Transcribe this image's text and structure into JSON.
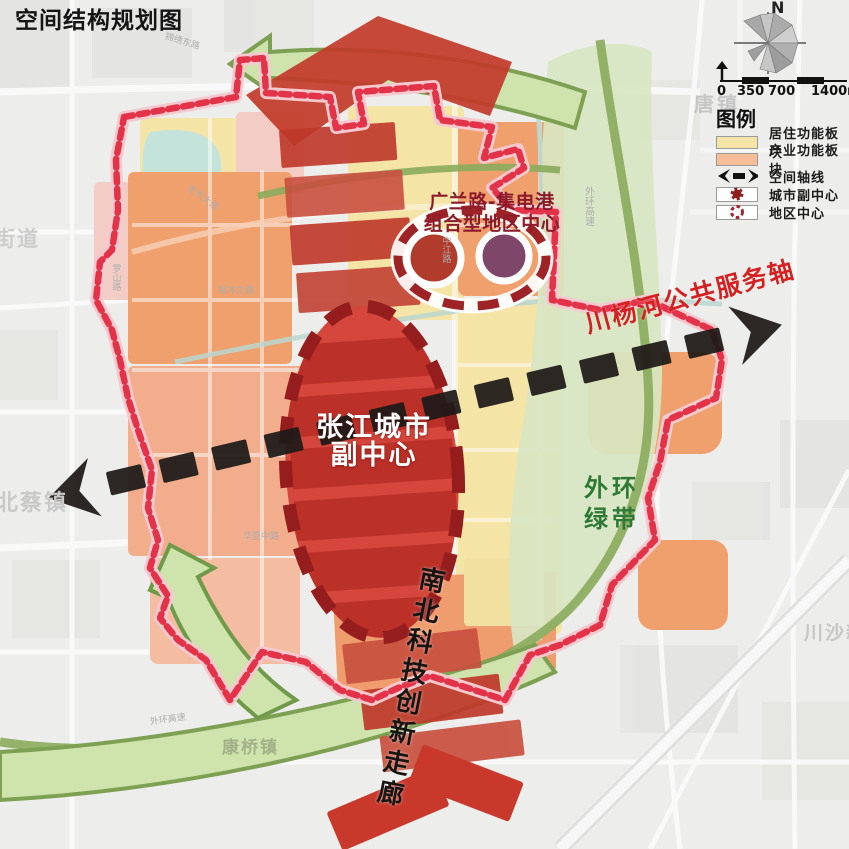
{
  "title": "空间结构规划图",
  "compass": {
    "north": "N"
  },
  "scale_bar": {
    "labels": [
      "0",
      "350",
      "700",
      "1400m"
    ]
  },
  "legend": {
    "title": "图例",
    "items": [
      {
        "label": "居住功能板块"
      },
      {
        "label": "产业功能板块"
      },
      {
        "label": "空间轴线"
      },
      {
        "label": "城市副中心"
      },
      {
        "label": "地区中心"
      }
    ]
  },
  "map": {
    "city_subcenter_line1": "张江城市",
    "city_subcenter_line2": "副中心",
    "district_center_line1": "广兰路-集电港",
    "district_center_line2": "组合型地区中心",
    "east_west_axis_label": "川杨河公共服务轴",
    "north_south_corridor_label": "南北科技创新走廊",
    "green_belt_line1": "外环",
    "green_belt_line2": "绿带",
    "town_labels": [
      {
        "text": "唐镇"
      },
      {
        "text": "街道"
      },
      {
        "text": "北蔡镇"
      },
      {
        "text": "康桥镇"
      },
      {
        "text": "川沙新镇"
      }
    ],
    "road_labels": [
      {
        "text": "锦绣东路"
      },
      {
        "text": "龙东大道"
      },
      {
        "text": "罗山路"
      },
      {
        "text": "祖冲之路"
      },
      {
        "text": "华夏中路"
      },
      {
        "text": "中江路"
      },
      {
        "text": "外环高速"
      },
      {
        "text": "外环高速"
      }
    ]
  },
  "colors": {
    "residential_yellow": "#f4e4a6",
    "industrial_orange": "#efa06c",
    "salmon": "#f2ad8c",
    "corridor_red": "#c23b2b",
    "subcenter_fill": "#d5463c",
    "subcenter_ring": "#951d1d",
    "boundary_red": "#e23349",
    "axis_black": "#1e1a18",
    "green_belt_fill": "#cfe3ac",
    "green_belt_edge": "#7da052",
    "axis_label_red": "#d42020",
    "green_label": "#2e7a35",
    "district_purple": "#7e476a",
    "district_red": "#b13c2c"
  }
}
